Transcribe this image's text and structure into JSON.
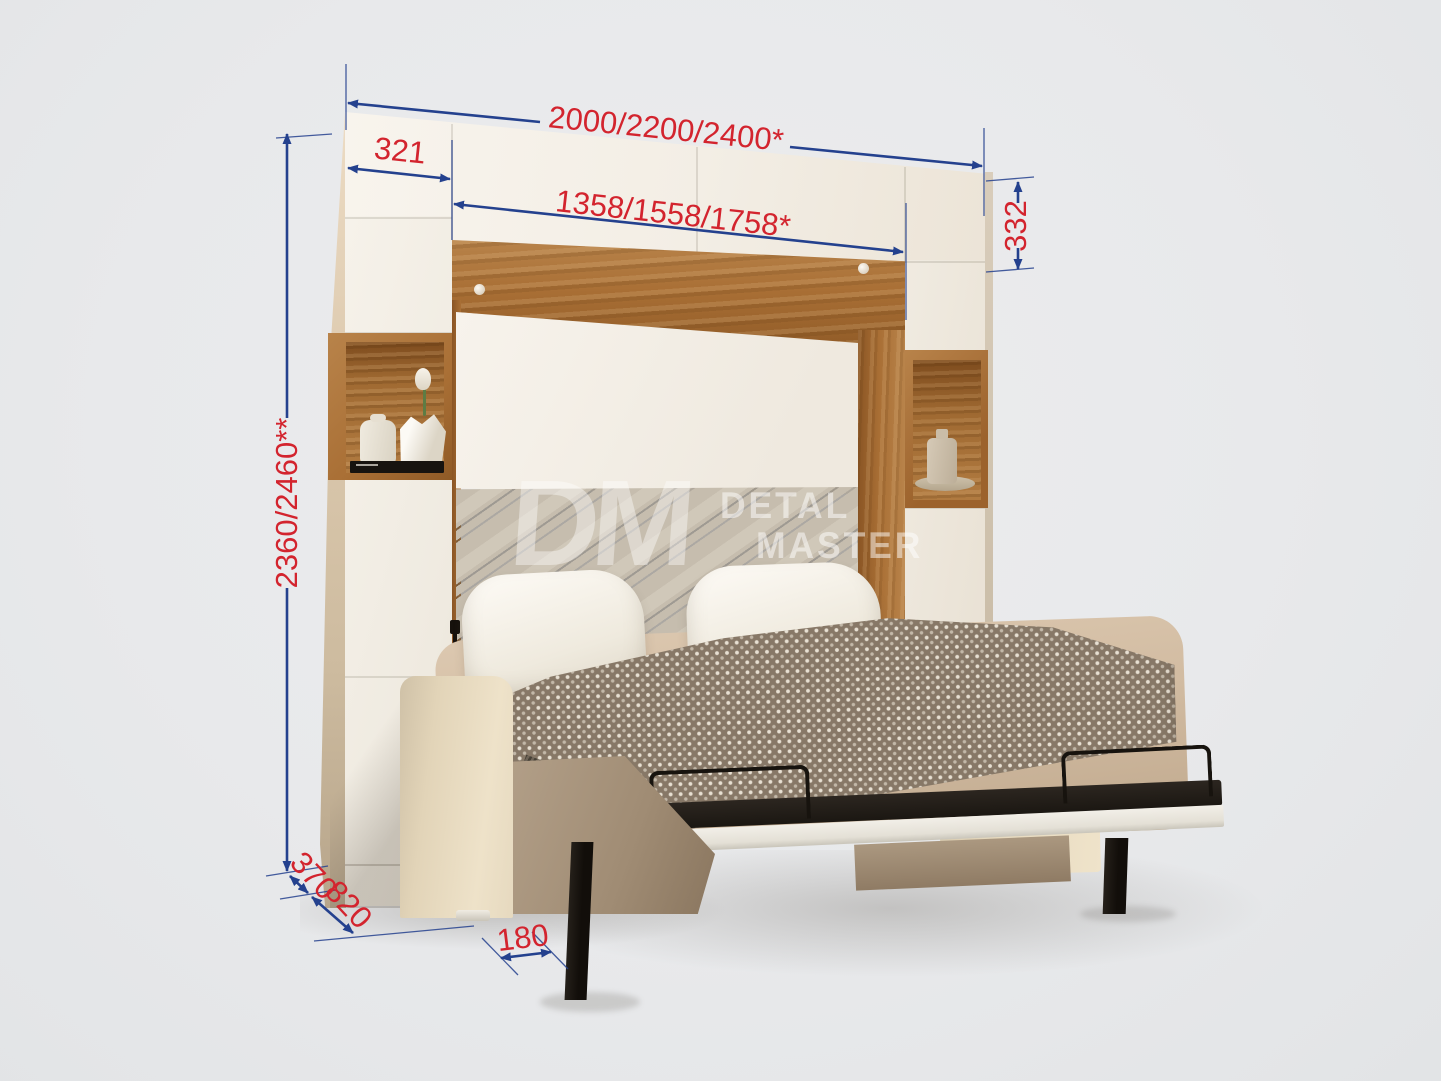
{
  "watermark": {
    "monogram": "DM",
    "line1": "DETAL",
    "line2": "MASTER"
  },
  "dimensions": {
    "total_width": "2000/2200/2400*",
    "left_cabinet_width": "321",
    "inner_width": "1358/1558/1758*",
    "top_cabinet_height": "332",
    "total_height": "2360/2460**",
    "cabinet_depth": "370",
    "sofa_depth": "820",
    "leg_offset": "180"
  },
  "colors": {
    "background": "#e8e9eb",
    "dimension_line": "#24418e",
    "dimension_text": "#d3242e",
    "cabinet_white": "#f4f0e8",
    "wood": "#a96f35",
    "headboard": "#c6bdae",
    "upholstery": "#e9dcc2",
    "metal_frame": "#17130e"
  }
}
